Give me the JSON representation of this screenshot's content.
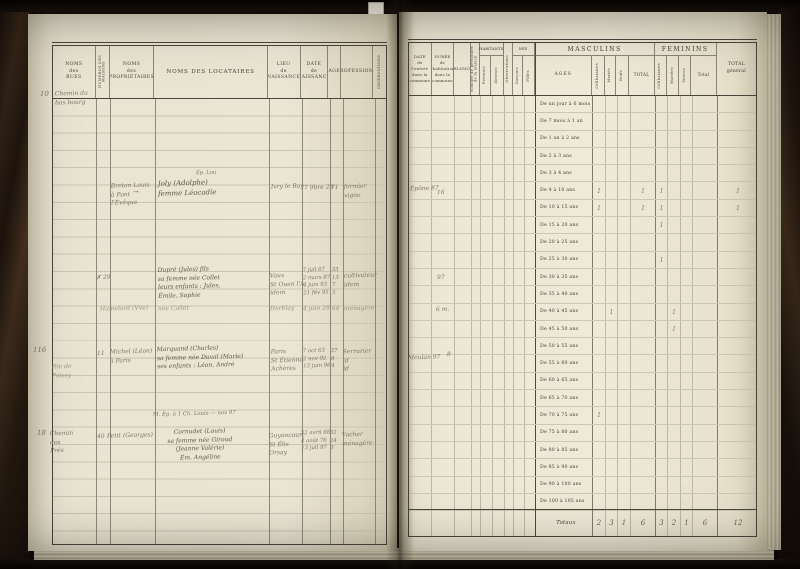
{
  "left_table": {
    "header": {
      "rues": "NOMS\ndes\nRUES",
      "numeros": "NUMÉROS DES MAISONS",
      "proprietaires": "NOMS\ndes\nPROPRIÉTAIRES",
      "locataires": "NOMS DES LOCATAIRES",
      "lieu": "LIEU\nde\nNAISSANCE",
      "date": "DATE\nde\nNAISSANCE",
      "age": "AGE",
      "professions": "PROFESSIONS",
      "observations": "OBSERVATIONS"
    },
    "entries": {
      "e1": {
        "margin": "10",
        "street": "Chemin du bas bourg"
      },
      "e2": {
        "note": "Ép. Lou",
        "proprietaire": "Breton Louis\nà Pont l'Évêque",
        "renvoi": "→",
        "locataires": "Joly (Adolphe)\nfemme Léocadie",
        "lieu": "Ivry le Roy",
        "date": "7 9bre 29",
        "age": "71",
        "professions": "fermier\nvigne"
      },
      "e3": {
        "numero": "✗ 29",
        "locataires": "Dupré (Jules) fils\nsa femme née Collet\nleurs enfants : Jules,\nÉmile, Sophie",
        "lieu": "Vaux\nSt Ouen l'A.\nidem",
        "dates": "7 juil 67\n2 mars 87\n4 juin 93\n21 fév 95",
        "ages": "33\n13\n7\n5",
        "professions": "cultivateur\nidem",
        "pencil_prop": "Hamelard (Vve)",
        "pencil_loc": "née Collet",
        "pencil_lieu": "Herblay",
        "pencil_date": "4 juin 28",
        "pencil_age": "68",
        "pencil_prof": "ménagère"
      },
      "e4": {
        "margin": "116",
        "street": "Rte de Poissy",
        "numero": "11",
        "proprietaire": "Michel (Léon)\nà Paris",
        "locataires": "Marquand (Charles)\nsa femme née Duval (Marie)\nses enfants : Léon, André",
        "lieu": "Paris\nSt Étienne\nAchères",
        "dates": "7 oct 63\n2 nov 92\n13 juin 96",
        "ages": "37\n8\n4",
        "professions": "Serrurier\nid\nid"
      },
      "e5": {
        "note": "M. Ép. à 1 Ch. Louis — nov 97",
        "margin": "18",
        "street": "Chemin des Prés",
        "numero": "40",
        "proprietaire": "Petit (Georges)",
        "locataires": "Cornudet (Louis)\nsa femme née Giroud (Jeanne Valérie)\nÉm. Angéline",
        "lieu": "Guyancourt\nSt Élix\nOrsay",
        "dates": "22 avril 68\n4 août 76\n13 juil 97",
        "ages": "32\n24\n3",
        "professions": "Vacher\nménagère"
      }
    }
  },
  "right_table": {
    "header": {
      "date_entree": "DATE\nde l'entrée\ndans la\ncommune",
      "duree": "DURÉE\nde\nl'habitation\ndans la\ncommune",
      "religion": "RELIGION",
      "nombre": "Nombre de personnes de la maison",
      "habitants": "HABITANTS",
      "presents": "Présents",
      "absents": "Absents",
      "observations": "Observations",
      "nes": "NÉS",
      "garcons": "Garçons",
      "filles": "Filles",
      "masculins": "MASCULINS",
      "ages": "AGES",
      "m_celibataires": "Célibataires",
      "m_maries": "Mariés",
      "m_veufs": "Veufs",
      "m_total": "TOTAL",
      "feminins": "FEMININS",
      "f_celibataires": "Célibataires",
      "f_mariees": "Mariées",
      "f_veuves": "Veuves",
      "f_total": "Total",
      "total_general": "TOTAL\ngénéral"
    },
    "age_rows": [
      {
        "label": "De un jour à 6 mois",
        "cells": [
          "",
          "",
          "",
          "",
          "",
          "",
          "",
          "",
          ""
        ]
      },
      {
        "label": "De 7 mois à 1 an",
        "cells": [
          "",
          "",
          "",
          "",
          "",
          "",
          "",
          "",
          ""
        ]
      },
      {
        "label": "De 1 an à 2 ans",
        "cells": [
          "",
          "",
          "",
          "",
          "",
          "",
          "",
          "",
          ""
        ]
      },
      {
        "label": "De 2 à 3 ans",
        "cells": [
          "",
          "",
          "",
          "",
          "",
          "",
          "",
          "",
          ""
        ]
      },
      {
        "label": "De 3 à 4 ans",
        "cells": [
          "",
          "",
          "",
          "",
          "",
          "",
          "",
          "",
          ""
        ]
      },
      {
        "label": "De 4 à 10 ans",
        "cells": [
          "1",
          "",
          "",
          "1",
          "1",
          "",
          "",
          "",
          "1"
        ]
      },
      {
        "label": "De 10 à 15 ans",
        "cells": [
          "1",
          "",
          "",
          "1",
          "1",
          "",
          "",
          "",
          "1"
        ]
      },
      {
        "label": "De 15 à 20 ans",
        "cells": [
          "",
          "",
          "",
          "",
          "1",
          "",
          "",
          "",
          ""
        ]
      },
      {
        "label": "De 20 à 25 ans",
        "cells": [
          "",
          "",
          "",
          "",
          "",
          "",
          "",
          "",
          ""
        ]
      },
      {
        "label": "De 25 à 30 ans",
        "cells": [
          "",
          "",
          "",
          "",
          "1",
          "",
          "",
          "",
          ""
        ]
      },
      {
        "label": "De 30 à 35 ans",
        "cells": [
          "",
          "",
          "",
          "",
          "",
          "",
          "",
          "",
          ""
        ]
      },
      {
        "label": "De 35 à 40 ans",
        "cells": [
          "",
          "",
          "",
          "",
          "",
          "",
          "",
          "",
          ""
        ]
      },
      {
        "label": "De 40 à 45 ans",
        "cells": [
          "",
          "1",
          "",
          "",
          "",
          "1",
          "",
          "",
          ""
        ]
      },
      {
        "label": "De 45 à 50 ans",
        "cells": [
          "",
          "",
          "",
          "",
          "",
          "1",
          "",
          "",
          ""
        ]
      },
      {
        "label": "De 50 à 55 ans",
        "cells": [
          "",
          "",
          "",
          "",
          "",
          "",
          "",
          "",
          ""
        ]
      },
      {
        "label": "De 55 à 60 ans",
        "cells": [
          "",
          "",
          "",
          "",
          "",
          "",
          "",
          "",
          ""
        ]
      },
      {
        "label": "De 60 à 65 ans",
        "cells": [
          "",
          "",
          "",
          "",
          "",
          "",
          "",
          "",
          ""
        ]
      },
      {
        "label": "De 65 à 70 ans",
        "cells": [
          "",
          "",
          "",
          "",
          "",
          "",
          "",
          "",
          ""
        ]
      },
      {
        "label": "De 70 à 75 ans",
        "cells": [
          "1",
          "",
          "",
          "",
          "",
          "",
          "",
          "",
          ""
        ]
      },
      {
        "label": "De 75 à 80 ans",
        "cells": [
          "",
          "",
          "",
          "",
          "",
          "",
          "",
          "",
          ""
        ]
      },
      {
        "label": "De 80 à 85 ans",
        "cells": [
          "",
          "",
          "",
          "",
          "",
          "",
          "",
          "",
          ""
        ]
      },
      {
        "label": "De 85 à 90 ans",
        "cells": [
          "",
          "",
          "",
          "",
          "",
          "",
          "",
          "",
          ""
        ]
      },
      {
        "label": "De 90 à 100 ans",
        "cells": [
          "",
          "",
          "",
          "",
          "",
          "",
          "",
          "",
          ""
        ]
      },
      {
        "label": "De 100 à 105 ans",
        "cells": [
          "",
          "",
          "",
          "",
          "",
          "",
          "",
          "",
          ""
        ]
      }
    ],
    "totaux": {
      "label": "Totaux",
      "cells": [
        "2",
        "3",
        "1",
        "6",
        "3",
        "2",
        "1",
        "6",
        "12"
      ]
    },
    "annotations": {
      "epone": "Épône 87",
      "n16": "16",
      "n97": "97",
      "six_m": "6 m.",
      "meulan": "Meulan 97",
      "n8": "8"
    }
  }
}
